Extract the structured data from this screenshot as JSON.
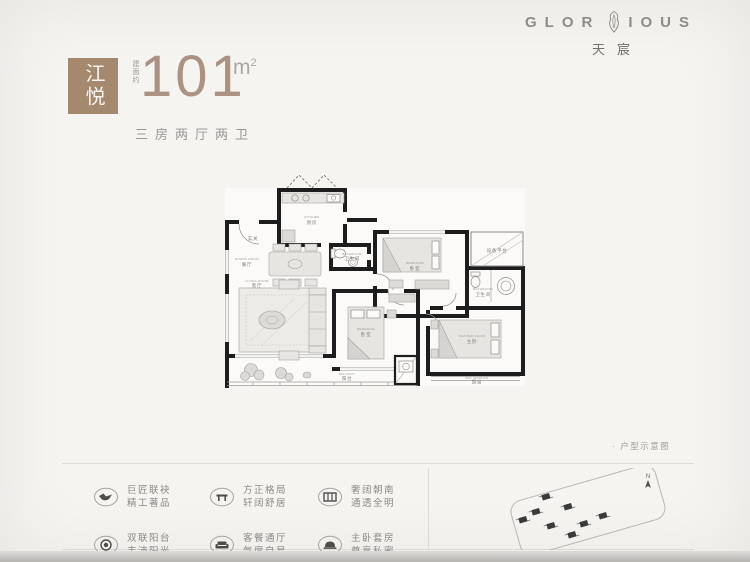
{
  "brand": {
    "logo_left": "GLOR",
    "logo_right": "IOUS",
    "logo_cn": "天宸"
  },
  "header": {
    "badge": "江悦",
    "area_prefix": "建面约",
    "area_value": "101",
    "area_unit": "m",
    "area_sup": "2",
    "layout_desc": "三房两厅两卫"
  },
  "floorplan": {
    "rooms": [
      {
        "en": "KITCHEN",
        "cn": "厨房"
      },
      {
        "en": "",
        "cn": "玄关"
      },
      {
        "en": "DINING ROOM",
        "cn": "餐厅"
      },
      {
        "en": "LIVING ROOM",
        "cn": "客厅"
      },
      {
        "en": "BALCONY",
        "cn": "阳台"
      },
      {
        "en": "BATHROOM",
        "cn": "卫生间"
      },
      {
        "en": "BEDROOM",
        "cn": "卧室"
      },
      {
        "en": "BEDROOM",
        "cn": "卧室"
      },
      {
        "en": "MASTER ROOM",
        "cn": "主卧"
      },
      {
        "en": "BATHROOM",
        "cn": "卫生间"
      },
      {
        "en": "",
        "cn": "设备平台"
      },
      {
        "en": "BAY WINDOW",
        "cn": "飘窗"
      }
    ]
  },
  "features": [
    {
      "icon": "handshake-icon",
      "line1": "巨匠联袂",
      "line2": "精工著品"
    },
    {
      "icon": "layout-icon",
      "line1": "方正格局",
      "line2": "轩阔舒居"
    },
    {
      "icon": "window-icon",
      "line1": "奢阔朝南",
      "line2": "通透全明"
    },
    {
      "icon": "sun-icon",
      "line1": "双联阳台",
      "line2": "丰沛阳光"
    },
    {
      "icon": "sofa-icon",
      "line1": "客餐通厅",
      "line2": "气度自显"
    },
    {
      "icon": "bed-icon",
      "line1": "主卧套房",
      "line2": "尊享私密"
    }
  ],
  "siteplan": {
    "north_label": "N",
    "caption": "· 户型示意图"
  },
  "colors": {
    "accent": "#a5896f",
    "number": "#ab9283",
    "text_gray": "#8c8a87"
  }
}
